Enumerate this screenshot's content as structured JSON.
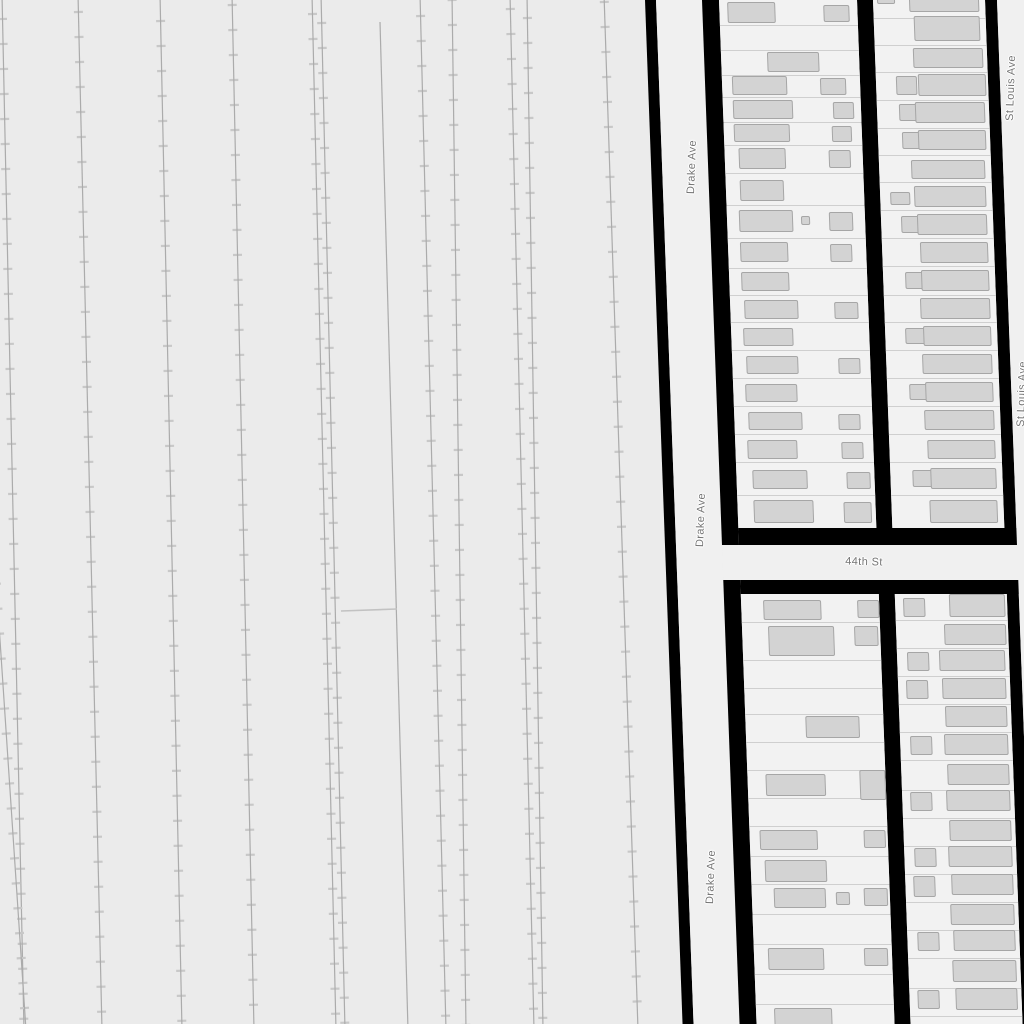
{
  "map": {
    "colors": {
      "background": "#ebebeb",
      "street_fill": "#f0f0f0",
      "parcel_fill": "#f2f2f2",
      "parcel_line": "#c9c9c9",
      "building_fill": "#d3d3d3",
      "building_stroke": "#a6a6a6",
      "block_outline": "#000000",
      "track_line": "#ababab",
      "track_tick": "#c8c8c8",
      "label_text": "#757575"
    },
    "labels": [
      {
        "text": "Drake Ave",
        "x": 692,
        "y": 167,
        "rot": -88
      },
      {
        "text": "Drake Ave",
        "x": 701,
        "y": 520,
        "rot": -88
      },
      {
        "text": "Drake Ave",
        "x": 711,
        "y": 877,
        "rot": -88
      },
      {
        "text": "St Louis Ave",
        "x": 1011,
        "y": 88,
        "rot": -88
      },
      {
        "text": "St Louis Ave",
        "x": 1022,
        "y": 394,
        "rot": -88
      },
      {
        "text": "44th St",
        "x": 864,
        "y": 562,
        "rot": 1.5
      }
    ],
    "railyard": {
      "tick_spacing": 25,
      "tick_length": 9,
      "tracks": [
        {
          "x1": 2,
          "y1": -6,
          "x2": 24,
          "y2": 1030,
          "ticks": true
        },
        {
          "x1": -6,
          "y1": 550,
          "x2": 26,
          "y2": 1030,
          "ticks": true
        },
        {
          "x1": 78,
          "y1": -6,
          "x2": 102,
          "y2": 1030,
          "ticks": true
        },
        {
          "x1": 160,
          "y1": -6,
          "x2": 182,
          "y2": 1030,
          "ticks": true
        },
        {
          "x1": 232,
          "y1": -6,
          "x2": 254,
          "y2": 1030,
          "ticks": true
        },
        {
          "x1": 312,
          "y1": -6,
          "x2": 336,
          "y2": 1030,
          "ticks": true
        },
        {
          "x1": 321,
          "y1": -6,
          "x2": 345,
          "y2": 1030,
          "ticks": true
        },
        {
          "x1": 380,
          "y1": 22,
          "x2": 408,
          "y2": 1030,
          "ticks": false
        },
        {
          "x1": 420,
          "y1": -6,
          "x2": 446,
          "y2": 1030,
          "ticks": true
        },
        {
          "x1": 452,
          "y1": -6,
          "x2": 466,
          "y2": 1030,
          "ticks": true
        },
        {
          "x1": 510,
          "y1": -6,
          "x2": 534,
          "y2": 1030,
          "ticks": true
        },
        {
          "x1": 527,
          "y1": -6,
          "x2": 543,
          "y2": 1030,
          "ticks": true
        },
        {
          "x1": 604,
          "y1": -6,
          "x2": 638,
          "y2": 1030,
          "ticks": true
        }
      ],
      "connector": {
        "x1": 341,
        "y1": 611,
        "x2": 397,
        "y2": 609
      }
    },
    "grid": {
      "origin_x": 645,
      "skew_deg": 2.1,
      "shapes": [
        {
          "t": "edge",
          "u": 0,
          "v": -10,
          "w": 11,
          "h": 1044
        },
        {
          "t": "street",
          "u": 11,
          "v": -10,
          "w": 46,
          "h": 1044
        },
        {
          "t": "edge",
          "u": 57,
          "v": -10,
          "w": 17,
          "h": 555
        },
        {
          "t": "edge",
          "u": 57,
          "v": 580,
          "w": 17,
          "h": 454
        },
        {
          "t": "edge",
          "u": 212,
          "v": -10,
          "w": 16,
          "h": 555
        },
        {
          "t": "edge",
          "u": 212,
          "v": 580,
          "w": 16,
          "h": 454
        },
        {
          "t": "edge",
          "u": 340,
          "v": -10,
          "w": 12,
          "h": 538
        },
        {
          "t": "edge",
          "u": 340,
          "v": 594,
          "w": 12,
          "h": 440
        },
        {
          "t": "street",
          "u": 352,
          "v": -10,
          "w": 48,
          "h": 1044
        },
        {
          "t": "edge",
          "u": 74,
          "v": 528,
          "w": 278,
          "h": 17
        },
        {
          "t": "street",
          "u": 57,
          "v": 545,
          "w": 343,
          "h": 35
        },
        {
          "t": "edge",
          "u": 74,
          "v": 580,
          "w": 278,
          "h": 14
        }
      ],
      "columns": [
        {
          "name": "block-north-west-of-alley",
          "u": 74,
          "w": 138,
          "v0": -10,
          "v1": 528,
          "rows": [
            -10,
            25,
            50,
            75,
            97,
            122,
            145,
            173,
            205,
            238,
            268,
            295,
            322,
            350,
            378,
            406,
            434,
            462,
            495,
            528
          ],
          "buildings": [
            [
              82,
              2,
              48,
              21
            ],
            [
              178,
              5,
              26,
              17
            ],
            [
              120,
              52,
              52,
              20
            ],
            [
              84,
              76,
              55,
              19
            ],
            [
              172,
              78,
              26,
              17
            ],
            [
              84,
              100,
              60,
              19
            ],
            [
              184,
              102,
              21,
              17
            ],
            [
              84,
              124,
              56,
              18
            ],
            [
              182,
              126,
              20,
              16
            ],
            [
              88,
              148,
              47,
              21
            ],
            [
              178,
              150,
              22,
              18
            ],
            [
              88,
              180,
              44,
              21
            ],
            [
              86,
              210,
              54,
              22
            ],
            [
              148,
              216,
              9,
              9
            ],
            [
              176,
              212,
              24,
              19
            ],
            [
              86,
              242,
              48,
              20
            ],
            [
              176,
              244,
              22,
              18
            ],
            [
              86,
              272,
              48,
              19
            ],
            [
              88,
              300,
              54,
              19
            ],
            [
              178,
              302,
              24,
              17
            ],
            [
              86,
              328,
              50,
              18
            ],
            [
              88,
              356,
              52,
              18
            ],
            [
              180,
              358,
              22,
              16
            ],
            [
              86,
              384,
              52,
              18
            ],
            [
              88,
              412,
              54,
              18
            ],
            [
              178,
              414,
              22,
              16
            ],
            [
              86,
              440,
              50,
              19
            ],
            [
              180,
              442,
              22,
              17
            ],
            [
              90,
              470,
              55,
              19
            ],
            [
              184,
              472,
              24,
              17
            ],
            [
              90,
              500,
              60,
              23
            ],
            [
              180,
              502,
              28,
              21
            ]
          ]
        },
        {
          "name": "block-north-east-of-alley",
          "u": 228,
          "w": 112,
          "v0": -10,
          "v1": 528,
          "rows": [
            -10,
            18,
            45,
            72,
            100,
            128,
            155,
            182,
            210,
            238,
            266,
            295,
            322,
            350,
            378,
            406,
            434,
            462,
            495,
            528
          ],
          "buildings": [
            [
              232,
              -8,
              18,
              12
            ],
            [
              264,
              -8,
              70,
              20
            ],
            [
              268,
              16,
              66,
              25
            ],
            [
              266,
              48,
              70,
              20
            ],
            [
              248,
              76,
              21,
              19
            ],
            [
              270,
              74,
              68,
              22
            ],
            [
              250,
              104,
              20,
              17
            ],
            [
              266,
              102,
              70,
              21
            ],
            [
              252,
              132,
              21,
              17
            ],
            [
              268,
              130,
              68,
              20
            ],
            [
              260,
              160,
              74,
              19
            ],
            [
              238,
              192,
              20,
              13
            ],
            [
              262,
              186,
              72,
              21
            ],
            [
              248,
              216,
              21,
              17
            ],
            [
              264,
              214,
              70,
              21
            ],
            [
              266,
              242,
              68,
              21
            ],
            [
              250,
              272,
              20,
              17
            ],
            [
              266,
              270,
              68,
              21
            ],
            [
              264,
              298,
              70,
              21
            ],
            [
              248,
              328,
              20,
              16
            ],
            [
              266,
              326,
              68,
              20
            ],
            [
              264,
              354,
              70,
              20
            ],
            [
              250,
              384,
              20,
              16
            ],
            [
              266,
              382,
              68,
              20
            ],
            [
              264,
              410,
              70,
              20
            ],
            [
              266,
              440,
              68,
              19
            ],
            [
              250,
              470,
              21,
              17
            ],
            [
              268,
              468,
              66,
              21
            ],
            [
              266,
              500,
              68,
              23
            ]
          ]
        },
        {
          "name": "block-south-west-of-alley",
          "u": 74,
          "w": 138,
          "v0": 594,
          "v1": 1030,
          "rows": [
            594,
            622,
            660,
            688,
            714,
            742,
            770,
            798,
            826,
            856,
            884,
            914,
            944,
            974,
            1004,
            1030
          ],
          "buildings": [
            [
              96,
              600,
              58,
              20
            ],
            [
              190,
              600,
              22,
              18
            ],
            [
              100,
              626,
              66,
              30
            ],
            [
              186,
              626,
              24,
              20
            ],
            [
              134,
              716,
              54,
              22
            ],
            [
              92,
              774,
              60,
              22
            ],
            [
              186,
              770,
              26,
              30
            ],
            [
              84,
              830,
              58,
              20
            ],
            [
              188,
              830,
              22,
              18
            ],
            [
              88,
              860,
              62,
              22
            ],
            [
              96,
              888,
              52,
              20
            ],
            [
              158,
              892,
              14,
              13
            ],
            [
              186,
              888,
              24,
              18
            ],
            [
              88,
              948,
              56,
              22
            ],
            [
              184,
              948,
              24,
              18
            ],
            [
              92,
              1008,
              58,
              20
            ]
          ]
        },
        {
          "name": "block-south-east-of-alley",
          "u": 228,
          "w": 112,
          "v0": 594,
          "v1": 1030,
          "rows": [
            594,
            620,
            648,
            676,
            704,
            732,
            760,
            790,
            818,
            846,
            874,
            902,
            930,
            958,
            988,
            1016,
            1030
          ],
          "buildings": [
            [
              236,
              598,
              22,
              19
            ],
            [
              282,
              594,
              56,
              23
            ],
            [
              276,
              624,
              62,
              21
            ],
            [
              238,
              652,
              22,
              19
            ],
            [
              270,
              650,
              66,
              21
            ],
            [
              236,
              680,
              22,
              19
            ],
            [
              272,
              678,
              64,
              21
            ],
            [
              274,
              706,
              62,
              21
            ],
            [
              238,
              736,
              22,
              19
            ],
            [
              272,
              734,
              64,
              21
            ],
            [
              274,
              764,
              62,
              21
            ],
            [
              236,
              792,
              22,
              19
            ],
            [
              272,
              790,
              64,
              21
            ],
            [
              274,
              820,
              62,
              21
            ],
            [
              238,
              848,
              22,
              19
            ],
            [
              272,
              846,
              64,
              21
            ],
            [
              236,
              876,
              22,
              21
            ],
            [
              274,
              874,
              62,
              21
            ],
            [
              272,
              904,
              64,
              21
            ],
            [
              238,
              932,
              22,
              19
            ],
            [
              274,
              930,
              62,
              21
            ],
            [
              272,
              960,
              64,
              22
            ],
            [
              236,
              990,
              22,
              19
            ],
            [
              274,
              988,
              62,
              22
            ]
          ]
        }
      ]
    }
  }
}
